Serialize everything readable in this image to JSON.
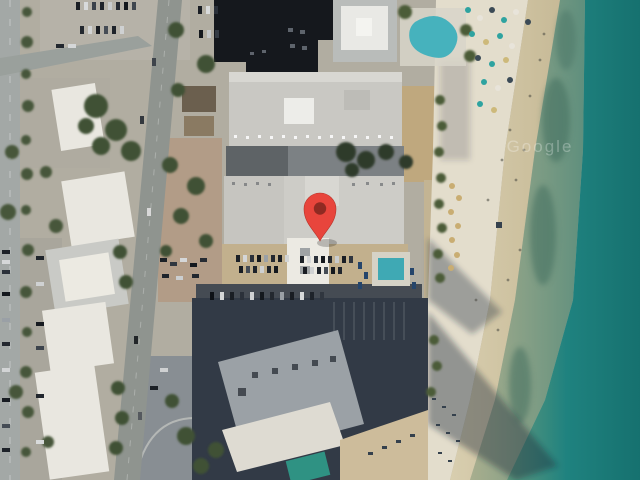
{
  "map": {
    "view_type": "satellite-imagery",
    "watermark": "Google",
    "marker": {
      "name": "red-map-pin",
      "color": "#E8453C",
      "dot_color": "#8F2A22",
      "tip_x": 320,
      "tip_y": 241
    },
    "palette": {
      "ocean_deep": "#16716F",
      "ocean_mid": "#1F827F",
      "ocean_shore": "#5F977D",
      "wet_sand": "#8BA287",
      "sand_tan": "#CFC2A0",
      "sand_white": "#E3DDCC",
      "land_base": "#B1ADA1",
      "road": "#8F948F",
      "roof_dark": "#15181D",
      "roof_light": "#C9C8C3",
      "pool": "#46B2BD"
    }
  }
}
